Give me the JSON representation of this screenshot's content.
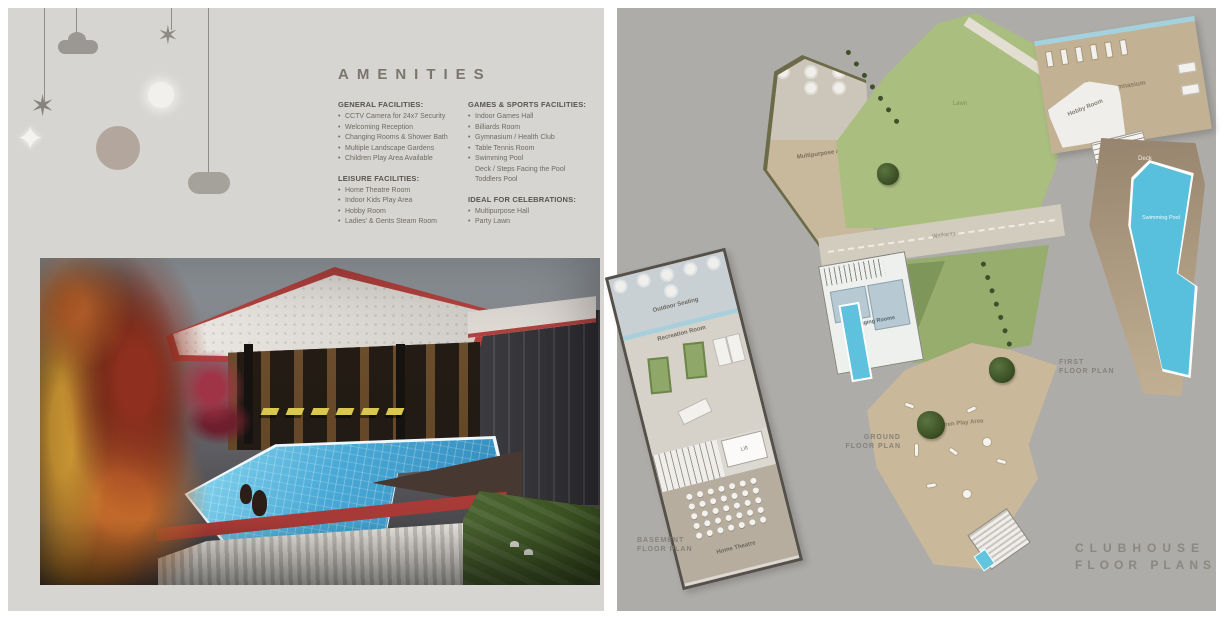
{
  "colors": {
    "page_left_bg": "#d7d5d1",
    "page_right_bg": "#aeaca8",
    "pool_blue": "#58bfdd",
    "lawn_green": "#aabe80",
    "accent_red": "#b2413e"
  },
  "amenities": {
    "title": "AMENITIES",
    "general": {
      "heading": "GENERAL FACILITIES:",
      "items": [
        "CCTV Camera for 24x7 Security",
        "Welcoming Reception",
        "Changing Rooms & Shower Bath",
        "Multiple Landscape Gardens",
        "Children Play Area Available"
      ]
    },
    "leisure": {
      "heading": "LEISURE FACILITIES:",
      "items": [
        "Home Theatre Room",
        "Indoor Kids Play Area",
        "Hobby Room",
        "Ladies' & Gents Steam Room"
      ]
    },
    "games": {
      "heading": "GAMES & SPORTS FACILITIES:",
      "items": [
        "Indoor Games Hall",
        "Billiards Room",
        "Gymnasium / Health Club",
        "Table Tennis Room",
        "Swimming Pool"
      ],
      "sub_items": [
        "Deck / Steps Facing the Pool",
        "Toddlers Pool"
      ]
    },
    "celebrations": {
      "heading": "IDEAL FOR CELEBRATIONS:",
      "items": [
        "Multipurpose Hall",
        "Party Lawn"
      ]
    }
  },
  "plans": {
    "basement": {
      "caption_line1": "BASEMENT",
      "caption_line2": "FLOOR PLAN",
      "labels": {
        "outdoor_seating": "Outdoor Seating",
        "recreation": "Recreation Room",
        "lift": "Lift",
        "home_theatre": "Home Theatre"
      }
    },
    "ground": {
      "caption_line1": "GROUND",
      "caption_line2": "FLOOR PLAN",
      "labels": {
        "lawn": "Lawn",
        "walkway": "Walkway",
        "multipurpose": "Multipurpose Area",
        "changing_rooms": "Changing Rooms",
        "children_play": "Children Play Area"
      }
    },
    "first": {
      "caption_line1": "FIRST",
      "caption_line2": "FLOOR PLAN",
      "labels": {
        "gymnasium": "Gymnasium",
        "hobby_room": "Hobby Room",
        "deck": "Deck",
        "swimming_pool": "Swimming Pool"
      }
    }
  },
  "clubhouse_heading": {
    "line1": "CLUBHOUSE",
    "line2": "FLOOR PLANS"
  }
}
